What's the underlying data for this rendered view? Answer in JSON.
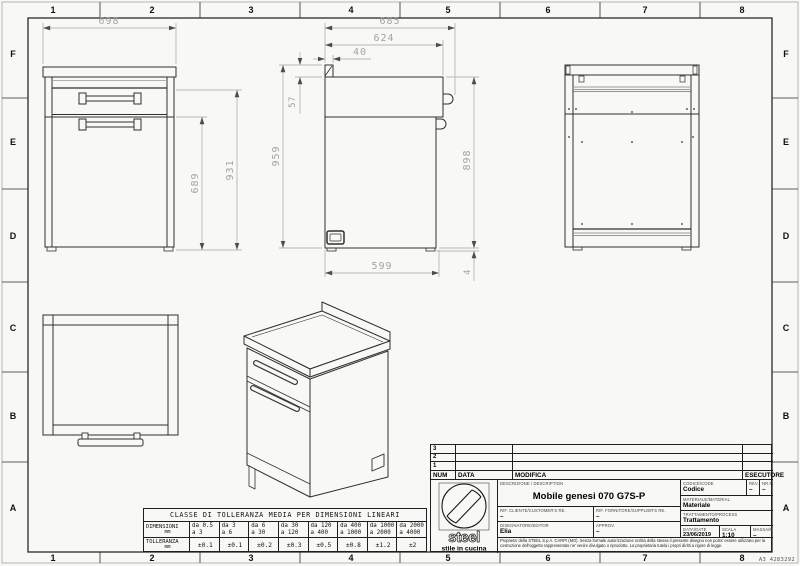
{
  "frame": {
    "columns": [
      "1",
      "2",
      "3",
      "4",
      "5",
      "6",
      "7",
      "8"
    ],
    "rows": [
      "F",
      "E",
      "D",
      "C",
      "B",
      "A"
    ],
    "sheet_code": "A3 4283292"
  },
  "views": {
    "front": {
      "dim_width": "698",
      "dim_height_door": "689",
      "dim_height_body": "931"
    },
    "side": {
      "dim_depth_total": "685",
      "dim_depth_body": "624",
      "dim_backsplash": "40",
      "dim_top_section": "57",
      "dim_height_total": "959",
      "dim_height_body": "898",
      "dim_depth_bottom": "599",
      "dim_foot": "4"
    }
  },
  "tolerance_table": {
    "title": "CLASSE DI TOLLERANZA MEDIA PER DIMENSIONI LINEARI",
    "dim_label": "DIMENSIONI",
    "dim_unit": "mm",
    "tol_label": "TOLLERANZA",
    "tol_unit": "mm",
    "ranges": [
      {
        "l1": "da 0.5",
        "l2": "a 3"
      },
      {
        "l1": "da 3",
        "l2": "a 6"
      },
      {
        "l1": "da 6",
        "l2": "a 30"
      },
      {
        "l1": "da 30",
        "l2": "a 120"
      },
      {
        "l1": "da 120",
        "l2": "a 400"
      },
      {
        "l1": "da 400",
        "l2": "a 1000"
      },
      {
        "l1": "da 1000",
        "l2": "a 2000"
      },
      {
        "l1": "da 2000",
        "l2": "a 4000"
      }
    ],
    "tolerances": [
      "±0.1",
      "±0.1",
      "±0.2",
      "±0.3",
      "±0.5",
      "±0.8",
      "±1.2",
      "±2"
    ]
  },
  "title_block": {
    "revisions": {
      "num": "NUM",
      "data": "DATA",
      "modifica": "MODIFICA",
      "esecutore": "ESECUTORE",
      "row3": "3",
      "row2": "2",
      "row1": "1"
    },
    "description_label": "DESCRIZIONE / DESCRIPTION",
    "description": "Mobile genesi 070 G7S-P",
    "codice_label": "CODICE/CODE",
    "codice": "Codice",
    "rev_label": "REV.",
    "rev": "–",
    "nrpz_label": "NR.PZ.",
    "nrpz": "–",
    "materiale_label": "MATERIALE/MATERIAL",
    "materiale": "Materiale",
    "rif_cliente_label": "RIF. CLIENTE/CUSTOMER'S RE.",
    "rif_cliente": "–",
    "rif_fornitore_label": "RIF. FORNITORE/SUPPLIER'S RE.",
    "rif_fornitore": "–",
    "trattamento_label": "TRATTAMENTO/PROCESS",
    "trattamento": "Trattamento",
    "disegnatore_label": "DISEGNATORE/EDITOR",
    "disegnatore": "Elia",
    "approv_label": "APPROV.",
    "approv": "–",
    "data_label": "DATA/DATE",
    "data": "23/06/2019",
    "scala_label": "SCALA",
    "scala": "1:10",
    "massa_label": "MASSA/MASS kg",
    "massa": "–",
    "disclaimer": "Proprieta' della STEEL S.p.A. CARPI (MO). Senza formale autorizzazione scritta della stessa il presente disegno non potra' essere utilizzato per la costruzione dell'oggetto rappresentato ne' venire divulgato o riprodotto. La proprietaria tutela i propri diritti a rigore di legge.",
    "logo_name": "steel",
    "logo_tagline": "stile in cucina"
  }
}
